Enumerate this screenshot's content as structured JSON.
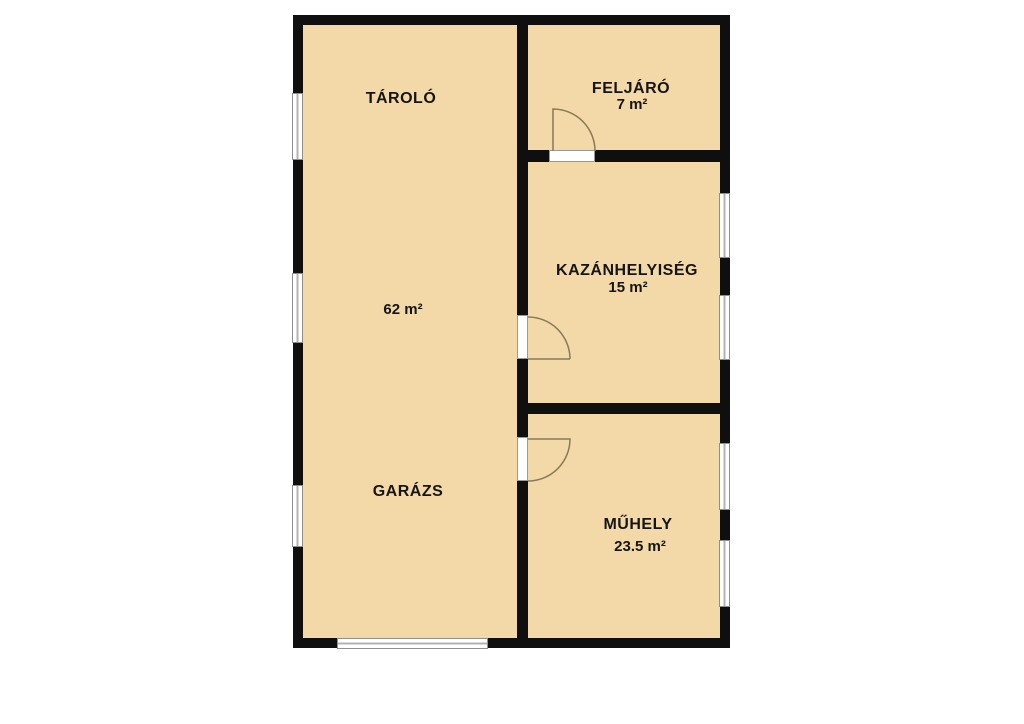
{
  "floorplan": {
    "type": "floor-plan",
    "language": "hu",
    "colors": {
      "floor": "#f3d9a7",
      "wall": "#0f0f0f",
      "window_frame": "#8f8f8f",
      "door_swing": "#8a795a",
      "background": "#ffffff"
    },
    "rooms": {
      "tarolo": {
        "name": "TÁROLÓ"
      },
      "feljaro": {
        "name": "FELJÁRÓ",
        "area": "7 m²"
      },
      "kazanhelyiseg": {
        "name": "KAZÁNHELYISÉG",
        "area": "15 m²"
      },
      "garazs": {
        "name": "GARÁZS",
        "area": "62 m²"
      },
      "muhely": {
        "name": "MŰHELY",
        "area": "23.5 m²"
      }
    }
  }
}
